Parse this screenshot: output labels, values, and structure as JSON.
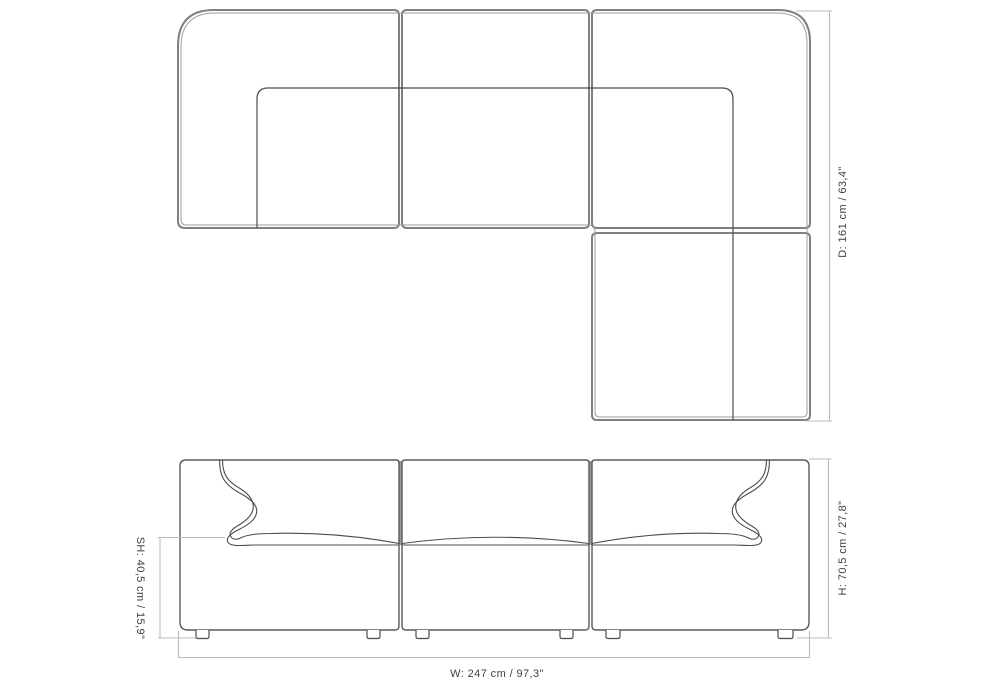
{
  "diagram": {
    "kind": "sofa-dimension-drawing",
    "views": {
      "top_view": "plan view of L-shaped modular sofa (3 modules + chaise)",
      "front_view": "front elevation of 3-module sofa with scroll armrests and 6 legs"
    },
    "dimensions": {
      "depth": "D: 161 cm / 63,4\"",
      "height": "H: 70,5 cm / 27,8\"",
      "seat_height": "SH: 40,5 cm / 15,9\"",
      "width": "W: 247 cm / 97,3\""
    },
    "colors": {
      "background": "#ffffff",
      "outline_heavy": "#808080",
      "outline_light": "#9e9e9e",
      "detail_line": "#4c4c4c",
      "front_outline": "#5a5a5a",
      "dimension_line": "#bbbbbb",
      "label_text": "#3f3f3f"
    }
  }
}
